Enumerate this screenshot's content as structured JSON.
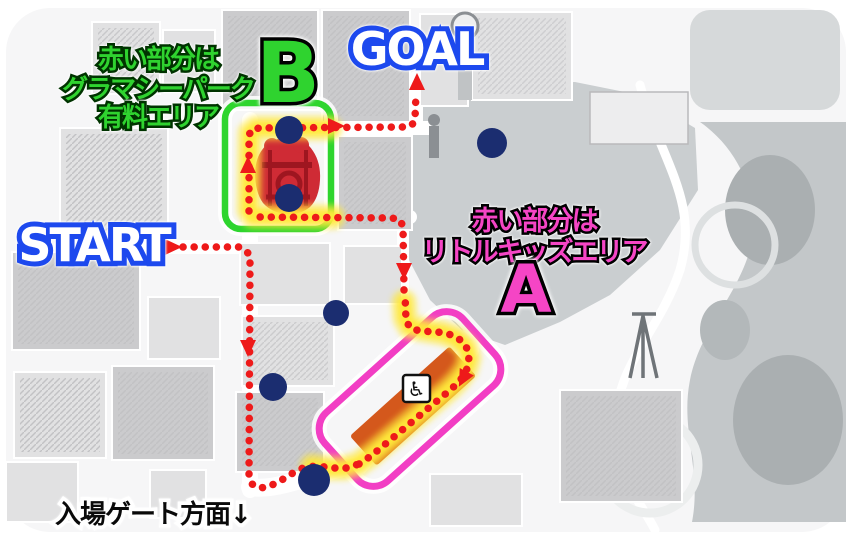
{
  "labels": {
    "start": "START",
    "goal": "GOAL",
    "marker_a": "A",
    "marker_b": "B",
    "area_b_note": [
      "赤い部分は",
      "グラマシーパーク",
      "有料エリア"
    ],
    "area_a_note": [
      "赤い部分は",
      "リトルキッズエリア"
    ],
    "gate_note": "入場ゲート方面↓",
    "wheelchair": "♿"
  },
  "colors": {
    "route_red": "#ee1a1a",
    "glow_yellow": "#ffe83a",
    "zone_green": "#2ed52e",
    "zone_magenta": "#f23ec4",
    "spot_navy": "#1b2d70",
    "area_red": "#cf2b35",
    "area_red_dark": "#9e1620",
    "strip_orange": "#d4581c",
    "label_blue": "#1d49ee",
    "text_green": "#2fd32f",
    "text_magenta": "#f545c5",
    "gate_black": "#0a0a0a"
  },
  "route": {
    "dot_width": 7.5,
    "dot_gap": 11,
    "segments": [
      [
        [
          183,
          247
        ],
        [
          240,
          247
        ],
        [
          248,
          253
        ],
        [
          250,
          263
        ]
      ],
      [
        [
          250,
          263
        ],
        [
          249,
          476
        ],
        [
          252,
          484
        ],
        [
          259,
          488
        ],
        [
          268,
          487
        ],
        [
          280,
          481
        ],
        [
          293,
          473
        ],
        [
          305,
          467
        ],
        [
          318,
          466
        ],
        [
          332,
          468
        ],
        [
          346,
          468
        ],
        [
          359,
          464
        ]
      ],
      [
        [
          359,
          464
        ],
        [
          371,
          456
        ],
        [
          449,
          391
        ],
        [
          459,
          382
        ],
        [
          466,
          372
        ],
        [
          469,
          361
        ],
        [
          468,
          350
        ],
        [
          462,
          341
        ],
        [
          452,
          335
        ],
        [
          438,
          332
        ],
        [
          420,
          331
        ],
        [
          410,
          328
        ],
        [
          406,
          320
        ],
        [
          405,
          295
        ]
      ],
      [
        [
          404,
          290
        ],
        [
          403,
          226
        ],
        [
          399,
          219
        ],
        [
          391,
          218
        ],
        [
          257,
          217
        ],
        [
          251,
          214
        ]
      ],
      [
        [
          249,
          211
        ],
        [
          249,
          135
        ],
        [
          252,
          129
        ],
        [
          260,
          128
        ],
        [
          405,
          127
        ],
        [
          412,
          125
        ],
        [
          415,
          119
        ],
        [
          416,
          93
        ]
      ]
    ],
    "glow_segments": [
      [
        [
          330,
          128
        ],
        [
          256,
          128
        ],
        [
          250,
          133
        ],
        [
          249,
          210
        ],
        [
          253,
          216
        ],
        [
          333,
          217
        ]
      ],
      [
        [
          404,
          302
        ],
        [
          405,
          318
        ],
        [
          410,
          327
        ],
        [
          425,
          330
        ],
        [
          443,
          333
        ],
        [
          456,
          338
        ],
        [
          466,
          347
        ],
        [
          469,
          358
        ],
        [
          466,
          369
        ],
        [
          458,
          380
        ],
        [
          449,
          389
        ],
        [
          371,
          455
        ],
        [
          358,
          464
        ],
        [
          344,
          468
        ],
        [
          330,
          468
        ],
        [
          312,
          466
        ]
      ]
    ],
    "arrows": [
      {
        "x": 171,
        "y": 247,
        "deg": 0
      },
      {
        "x": 248,
        "y": 167,
        "deg": -90
      },
      {
        "x": 334,
        "y": 126,
        "deg": 0
      },
      {
        "x": 417,
        "y": 84,
        "deg": -90
      },
      {
        "x": 248,
        "y": 346,
        "deg": 90
      },
      {
        "x": 404,
        "y": 269,
        "deg": 90
      },
      {
        "x": 464,
        "y": 377,
        "deg": 118
      }
    ]
  },
  "spots": [
    {
      "x": 289,
      "y": 130,
      "r": 14
    },
    {
      "x": 289,
      "y": 198,
      "r": 14
    },
    {
      "x": 492,
      "y": 143,
      "r": 15
    },
    {
      "x": 336,
      "y": 313,
      "r": 13
    },
    {
      "x": 273,
      "y": 387,
      "r": 14
    },
    {
      "x": 314,
      "y": 480,
      "r": 16
    }
  ],
  "areas": {
    "b_zone_rect": {
      "x": 225,
      "y": 103,
      "w": 106,
      "h": 126,
      "r": 16
    },
    "a_zone_rect": {
      "cx": 410,
      "cy": 399,
      "w": 186,
      "h": 92,
      "r": 22,
      "angle": -42
    },
    "a_red_strip": {
      "cx": 413,
      "cy": 406,
      "w": 134,
      "h": 40,
      "angle": -42
    },
    "wheelchair_box": {
      "x": 403,
      "y": 375,
      "size": 27
    }
  }
}
